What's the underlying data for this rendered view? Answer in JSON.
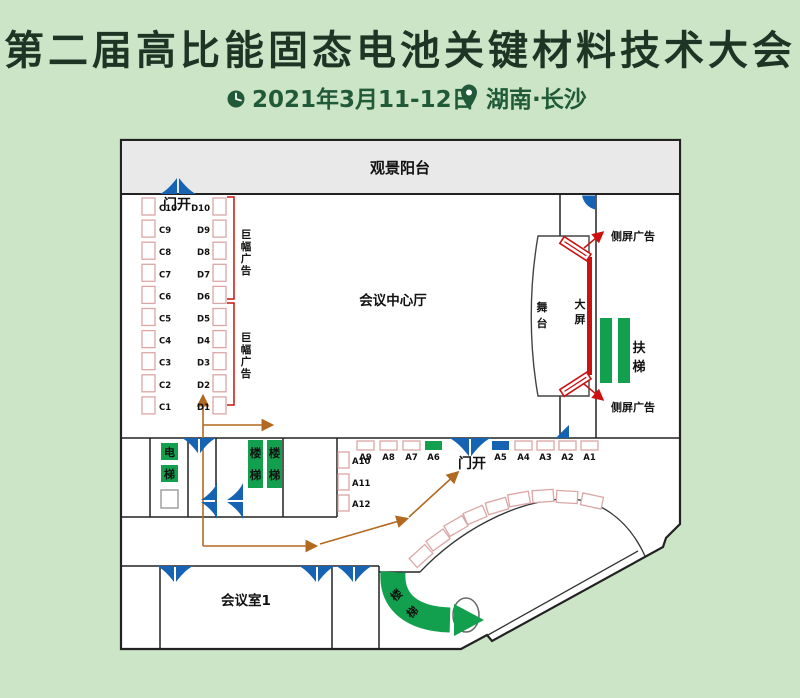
{
  "header": {
    "title": "第二届高比能固态电池关键材料技术大会",
    "date": "2021年3月11-12日",
    "location": "湖南·长沙"
  },
  "plan": {
    "balcony": "观景阳台",
    "hall": "会议中心厅",
    "meeting_room": "会议室1",
    "door_open": "门开",
    "stage": "舞台",
    "big_screen": "大屏",
    "side_screen_ad": "侧屏广告",
    "escalator": "扶梯",
    "elevator": "电梯",
    "stairs": "楼梯",
    "banner_ad": "巨幅广告",
    "booths_c": [
      "C10",
      "C9",
      "C8",
      "C7",
      "C6",
      "C5",
      "C4",
      "C3",
      "C2",
      "C1"
    ],
    "booths_d": [
      "D10",
      "D9",
      "D8",
      "D7",
      "D6",
      "D5",
      "D4",
      "D3",
      "D2",
      "D1"
    ],
    "booths_a_row": [
      "A9",
      "A8",
      "A7",
      "A6",
      "A5",
      "A4",
      "A3",
      "A2",
      "A1"
    ],
    "booths_a_col": [
      "A10",
      "A11",
      "A12"
    ],
    "booths_b": [
      "B1",
      "B2",
      "B3",
      "B4",
      "B5",
      "B6",
      "B7",
      "B8",
      "B9"
    ]
  },
  "colors": {
    "background": "#cbe5c6",
    "title": "#1e3526",
    "accent_green": "#215a38",
    "green": "#12a04e",
    "blue": "#1563b2",
    "red": "#cc1111",
    "orange": "#b2691f",
    "wall": "#222222",
    "booth_border": "#dca6a6",
    "balcony_fill": "#e9e9e9"
  }
}
